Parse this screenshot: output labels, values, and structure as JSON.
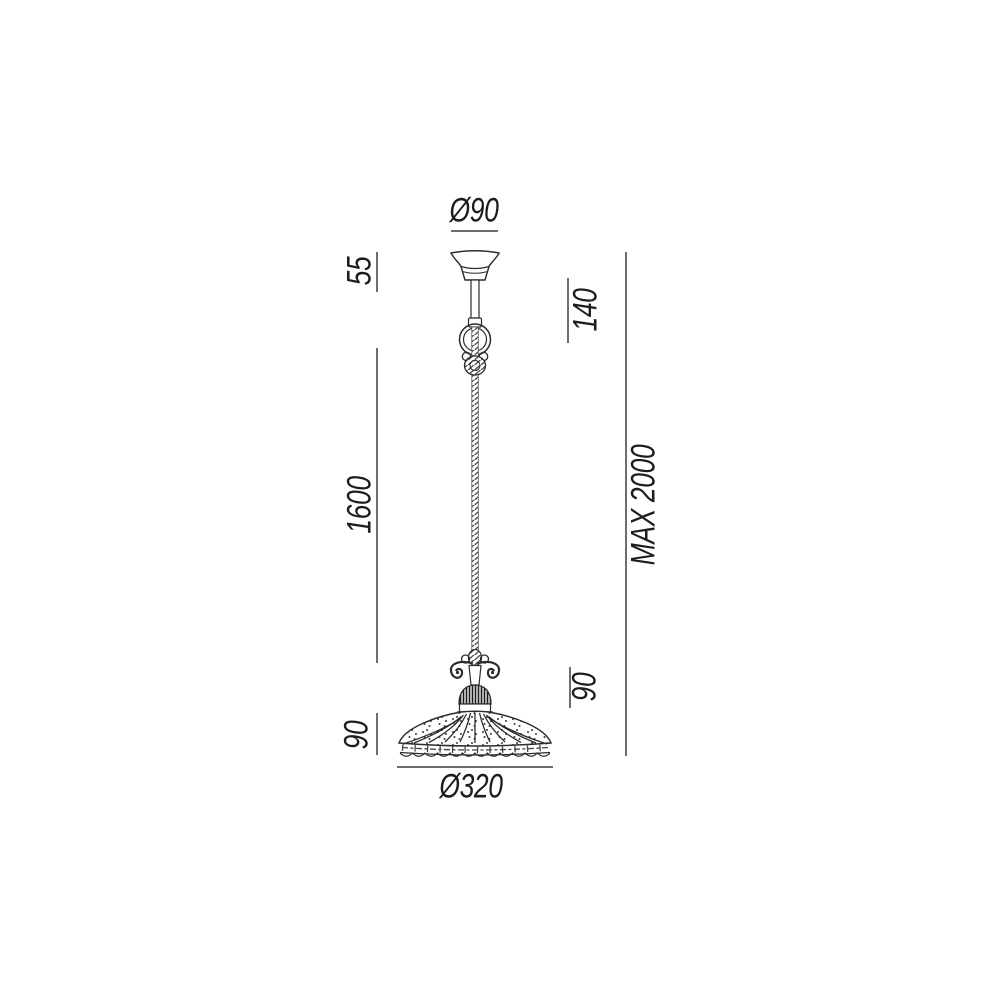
{
  "drawing": {
    "type": "technical-dimension-drawing",
    "subject": "pendant lamp with decorative shade, twisted cable and ceiling canopy",
    "colors": {
      "background": "#ffffff",
      "outline": "#2b2b2b",
      "dimension_line": "#6e6e6e",
      "label_text": "#1d1d1d"
    },
    "labels": {
      "canopy_diameter": "Ø90",
      "canopy_height": "55",
      "top_section_height": "140",
      "cable_length": "1600",
      "max_overall_height": "MAX 2000",
      "holder_section_height": "90",
      "shade_height": "90",
      "shade_diameter": "Ø320"
    }
  }
}
